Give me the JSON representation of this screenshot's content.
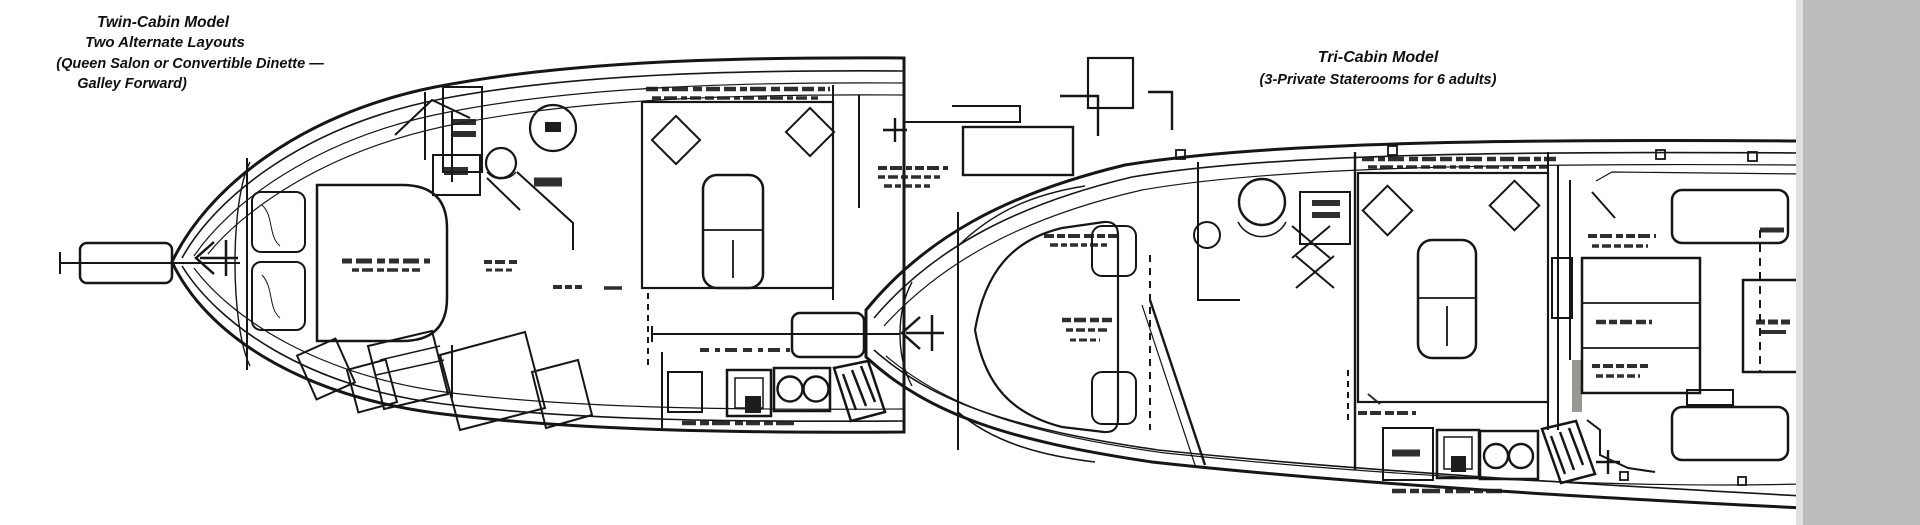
{
  "figure": {
    "left_plan": {
      "name": "Twin-Cabin Model floor plan",
      "title_lines": [
        "Twin-Cabin Model",
        "Two Alternate Layouts",
        "(Queen Salon or Convertible Dinette —",
        "Galley Forward)"
      ]
    },
    "right_plan": {
      "name": "Tri-Cabin Model floor plan",
      "title_lines": [
        "Tri-Cabin Model",
        "(3-Private Staterooms for 6 adults)"
      ]
    },
    "colors": {
      "ink": "#161616",
      "paper": "#ffffff",
      "scan_bar": "#bcbcbc",
      "stipple_base": "#d7d4ce"
    }
  }
}
